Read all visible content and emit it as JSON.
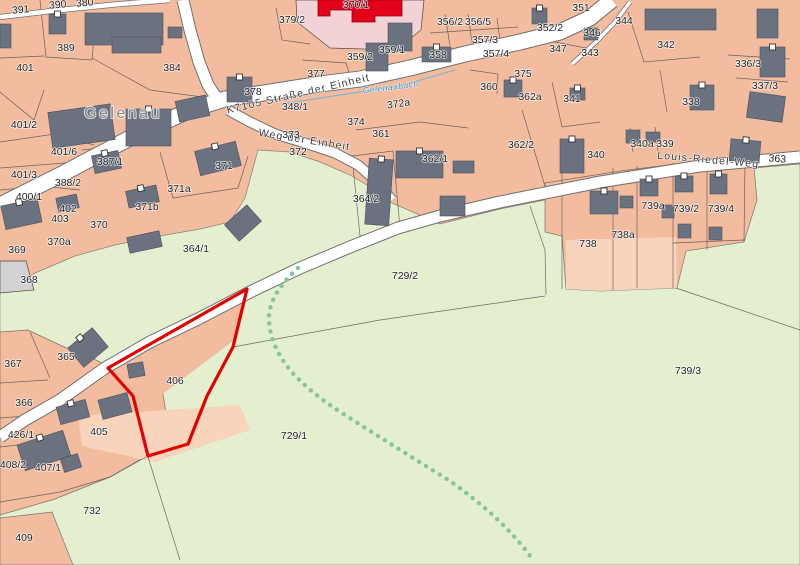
{
  "map": {
    "type": "cadastral-parcel-map",
    "place_label": "Gelenau",
    "selected_parcel": "406",
    "streets": [
      {
        "name": "K7105 Straße der Einheit"
      },
      {
        "name": "Weg der Einheit"
      },
      {
        "name": "Louis-Riedel-Weg"
      }
    ],
    "stream_name": "Gelenaubach",
    "colors": {
      "field_green": "#e3efcf",
      "built_salmon": "#f3bc9f",
      "light_salmon": "#f8d4bd",
      "civic_pink": "#f3d2d6",
      "public_building_red": "#e2001a",
      "building_gray": "#6a7280",
      "road_white": "#ffffff",
      "selected_outline_red": "#e30000",
      "path_dot_green": "#86c596",
      "stream_blue": "#4e88b4"
    },
    "labels": [
      {
        "text": "Gelenau",
        "x": 123,
        "y": 118,
        "kind": "place"
      },
      {
        "text": "K7105 Straße der Einheit",
        "x": 299,
        "y": 97,
        "rot": -13,
        "kind": "street"
      },
      {
        "text": "Weg der Einheit",
        "x": 304,
        "y": 143,
        "rot": 9,
        "kind": "street"
      },
      {
        "text": "Louis-Riedel-Weg",
        "x": 708,
        "y": 163,
        "rot": 5,
        "kind": "street"
      },
      {
        "text": "Gelenaubach",
        "x": 391,
        "y": 90,
        "rot": -7,
        "kind": "stream"
      },
      {
        "text": "391",
        "x": 21,
        "y": 13,
        "rot": -5
      },
      {
        "text": "390",
        "x": 58,
        "y": 8,
        "rot": -5
      },
      {
        "text": "380",
        "x": 85,
        "y": 6,
        "rot": -5
      },
      {
        "text": "389",
        "x": 66,
        "y": 51
      },
      {
        "text": "401",
        "x": 25,
        "y": 71
      },
      {
        "text": "384",
        "x": 172,
        "y": 71
      },
      {
        "text": "378",
        "x": 253,
        "y": 95
      },
      {
        "text": "377",
        "x": 316,
        "y": 77
      },
      {
        "text": "379/2",
        "x": 292,
        "y": 23
      },
      {
        "text": "370/1",
        "x": 356,
        "y": 8
      },
      {
        "text": "359/1",
        "x": 392,
        "y": 53
      },
      {
        "text": "359/2",
        "x": 360,
        "y": 60
      },
      {
        "text": "356/2",
        "x": 450,
        "y": 25
      },
      {
        "text": "356/5",
        "x": 478,
        "y": 25
      },
      {
        "text": "357/3",
        "x": 485,
        "y": 43
      },
      {
        "text": "358",
        "x": 438,
        "y": 58
      },
      {
        "text": "357/4",
        "x": 496,
        "y": 57
      },
      {
        "text": "360",
        "x": 489,
        "y": 90
      },
      {
        "text": "375",
        "x": 523,
        "y": 77
      },
      {
        "text": "362a",
        "x": 530,
        "y": 100
      },
      {
        "text": "352/2",
        "x": 550,
        "y": 31
      },
      {
        "text": "351",
        "x": 581,
        "y": 11
      },
      {
        "text": "344",
        "x": 624,
        "y": 24
      },
      {
        "text": "346",
        "x": 592,
        "y": 36
      },
      {
        "text": "347",
        "x": 558,
        "y": 52
      },
      {
        "text": "343",
        "x": 590,
        "y": 56
      },
      {
        "text": "342",
        "x": 666,
        "y": 48
      },
      {
        "text": "336/3",
        "x": 748,
        "y": 67
      },
      {
        "text": "337/3",
        "x": 765,
        "y": 89
      },
      {
        "text": "341",
        "x": 572,
        "y": 102
      },
      {
        "text": "338",
        "x": 691,
        "y": 105
      },
      {
        "text": "340a",
        "x": 642,
        "y": 147
      },
      {
        "text": "339",
        "x": 665,
        "y": 147
      },
      {
        "text": "340",
        "x": 596,
        "y": 158
      },
      {
        "text": "363",
        "x": 777,
        "y": 162,
        "rot": 5
      },
      {
        "text": "348/1",
        "x": 295,
        "y": 110
      },
      {
        "text": "372a",
        "x": 399,
        "y": 107,
        "rot": -8
      },
      {
        "text": "374",
        "x": 356,
        "y": 125
      },
      {
        "text": "373",
        "x": 291,
        "y": 138
      },
      {
        "text": "372",
        "x": 298,
        "y": 155
      },
      {
        "text": "361",
        "x": 381,
        "y": 137
      },
      {
        "text": "362/1",
        "x": 435,
        "y": 162
      },
      {
        "text": "362/2",
        "x": 521,
        "y": 148
      },
      {
        "text": "401/2",
        "x": 24,
        "y": 128
      },
      {
        "text": "401/6",
        "x": 64,
        "y": 155
      },
      {
        "text": "387/1",
        "x": 110,
        "y": 165
      },
      {
        "text": "401/3",
        "x": 24,
        "y": 178
      },
      {
        "text": "388/2",
        "x": 68,
        "y": 186
      },
      {
        "text": "400/1",
        "x": 29,
        "y": 200
      },
      {
        "text": "402",
        "x": 68,
        "y": 212
      },
      {
        "text": "403",
        "x": 60,
        "y": 222
      },
      {
        "text": "370",
        "x": 99,
        "y": 228
      },
      {
        "text": "370a",
        "x": 59,
        "y": 245
      },
      {
        "text": "369",
        "x": 17,
        "y": 253
      },
      {
        "text": "368",
        "x": 29,
        "y": 283
      },
      {
        "text": "371",
        "x": 224,
        "y": 169
      },
      {
        "text": "371a",
        "x": 179,
        "y": 192
      },
      {
        "text": "371b",
        "x": 147,
        "y": 210
      },
      {
        "text": "364/2",
        "x": 366,
        "y": 202
      },
      {
        "text": "364/1",
        "x": 196,
        "y": 252
      },
      {
        "text": "729/2",
        "x": 405,
        "y": 279
      },
      {
        "text": "729/1",
        "x": 294,
        "y": 439
      },
      {
        "text": "365",
        "x": 66,
        "y": 360
      },
      {
        "text": "367",
        "x": 13,
        "y": 367
      },
      {
        "text": "366",
        "x": 24,
        "y": 406
      },
      {
        "text": "426/1",
        "x": 21,
        "y": 438
      },
      {
        "text": "408/2",
        "x": 13,
        "y": 468
      },
      {
        "text": "407/1",
        "x": 48,
        "y": 471
      },
      {
        "text": "405",
        "x": 99,
        "y": 435
      },
      {
        "text": "406",
        "x": 175,
        "y": 384
      },
      {
        "text": "732",
        "x": 92,
        "y": 514
      },
      {
        "text": "409",
        "x": 24,
        "y": 541
      },
      {
        "text": "738",
        "x": 588,
        "y": 247
      },
      {
        "text": "738a",
        "x": 623,
        "y": 238
      },
      {
        "text": "739a",
        "x": 653,
        "y": 209
      },
      {
        "text": "739/2",
        "x": 686,
        "y": 212
      },
      {
        "text": "739/4",
        "x": 721,
        "y": 212
      },
      {
        "text": "739/3",
        "x": 688,
        "y": 374
      }
    ]
  }
}
